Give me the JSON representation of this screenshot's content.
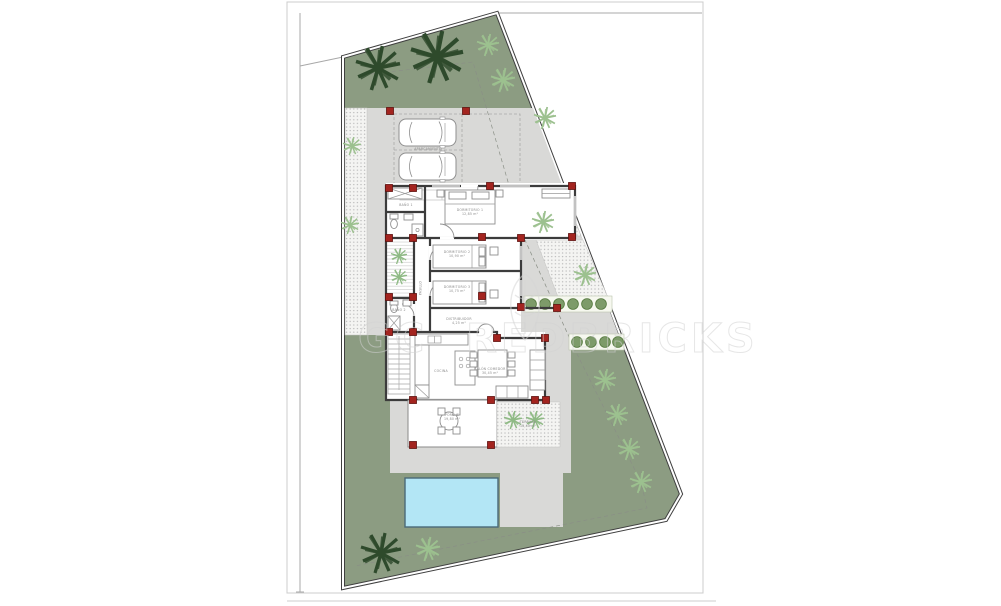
{
  "watermark": {
    "left": "GC",
    "right": "REDBRICKS",
    "logo": "leaf-shield-logo"
  },
  "colors": {
    "landscape_green": "#8c9c82",
    "paving_gray": "#d9d9d7",
    "pool_blue": "#b3e6f5",
    "pool_border": "#4a6a78",
    "column_red": "#a3241f",
    "wall_dark": "#3c3c3c",
    "shrub_green": "#7d9b69",
    "palm_dark": "#2e4a2c",
    "palm_light": "#9cc08f",
    "watermark_gray": "#d2d2d2"
  },
  "rooms": [
    {
      "id": "bano1",
      "name": "BAÑO 1",
      "area": "4,15 m²"
    },
    {
      "id": "dormitorio1",
      "name": "DORMITORIO 1",
      "area": "12,85 m²"
    },
    {
      "id": "dormitorio2",
      "name": "DORMITORIO 2",
      "area": "10,90 m²"
    },
    {
      "id": "dormitorio3",
      "name": "DORMITORIO 3",
      "area": "10,75 m²"
    },
    {
      "id": "pasillo",
      "name": "PASILLO",
      "area": ""
    },
    {
      "id": "distribuidor",
      "name": "DISTRIBUIDOR",
      "area": "4,25 m²"
    },
    {
      "id": "bano2",
      "name": "BAÑO 2",
      "area": "3,90 m²"
    },
    {
      "id": "cocina",
      "name": "COCINA",
      "area": ""
    },
    {
      "id": "salon",
      "name": "SALÓN COMEDOR",
      "area": "30,45 m²"
    },
    {
      "id": "porche",
      "name": "PORCHE",
      "area": "19,80 m²"
    },
    {
      "id": "terraza",
      "name": "TERRAZA",
      "area": "15,40 m²"
    },
    {
      "id": "aparcamiento",
      "name": "APARCAMIENTO",
      "area": ""
    }
  ]
}
